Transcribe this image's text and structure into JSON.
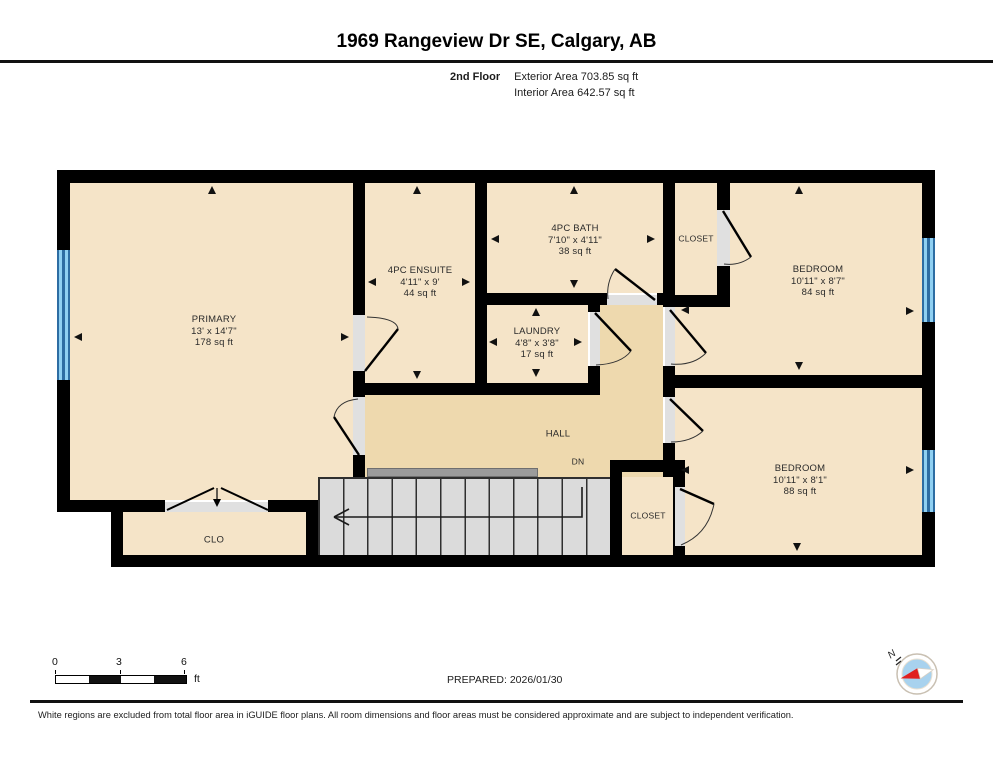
{
  "header": {
    "title": "1969 Rangeview Dr SE, Calgary, AB",
    "floor_label": "2nd Floor",
    "exterior_area": "Exterior Area 703.85 sq ft",
    "interior_area": "Interior Area 642.57 sq ft"
  },
  "plan": {
    "rooms": {
      "primary": {
        "name": "PRIMARY",
        "dims": "13' x 14'7\"",
        "area": "178 sq ft"
      },
      "ensuite": {
        "name": "4PC ENSUITE",
        "dims": "4'11\" x 9'",
        "area": "44 sq ft"
      },
      "bath": {
        "name": "4PC BATH",
        "dims": "7'10\" x 4'11\"",
        "area": "38 sq ft"
      },
      "closet_top": {
        "name": "CLOSET"
      },
      "bedroom_top": {
        "name": "BEDROOM",
        "dims": "10'11\" x 8'7\"",
        "area": "84 sq ft"
      },
      "laundry": {
        "name": "LAUNDRY",
        "dims": "4'8\" x 3'8\"",
        "area": "17 sq ft"
      },
      "hall": {
        "name": "HALL"
      },
      "stairs": {
        "label": "DN"
      },
      "closet_stairs": {
        "name": "CLOSET"
      },
      "bedroom_bottom": {
        "name": "BEDROOM",
        "dims": "10'11\" x 8'1\"",
        "area": "88 sq ft"
      },
      "clo": {
        "name": "CLO"
      }
    },
    "colors": {
      "wall": "#000000",
      "room_fill": "#F5E4C8",
      "hall_fill": "#EED9AE",
      "window_blue": "#8FD0F2",
      "stairs_gray": "#DBDBDB",
      "door_opening": "#E0E0E0",
      "compass_needle_red": "#E02020",
      "compass_face_blue": "#A8D2EE"
    }
  },
  "footer": {
    "scale_bar": {
      "ticks": [
        "0",
        "3",
        "6"
      ],
      "unit": "ft"
    },
    "prepared": "PREPARED: 2026/01/30",
    "compass_label": "N",
    "disclaimer": "White regions are excluded from total floor area in iGUIDE floor plans. All room dimensions and floor areas must be considered approximate and are subject to independent verification."
  }
}
